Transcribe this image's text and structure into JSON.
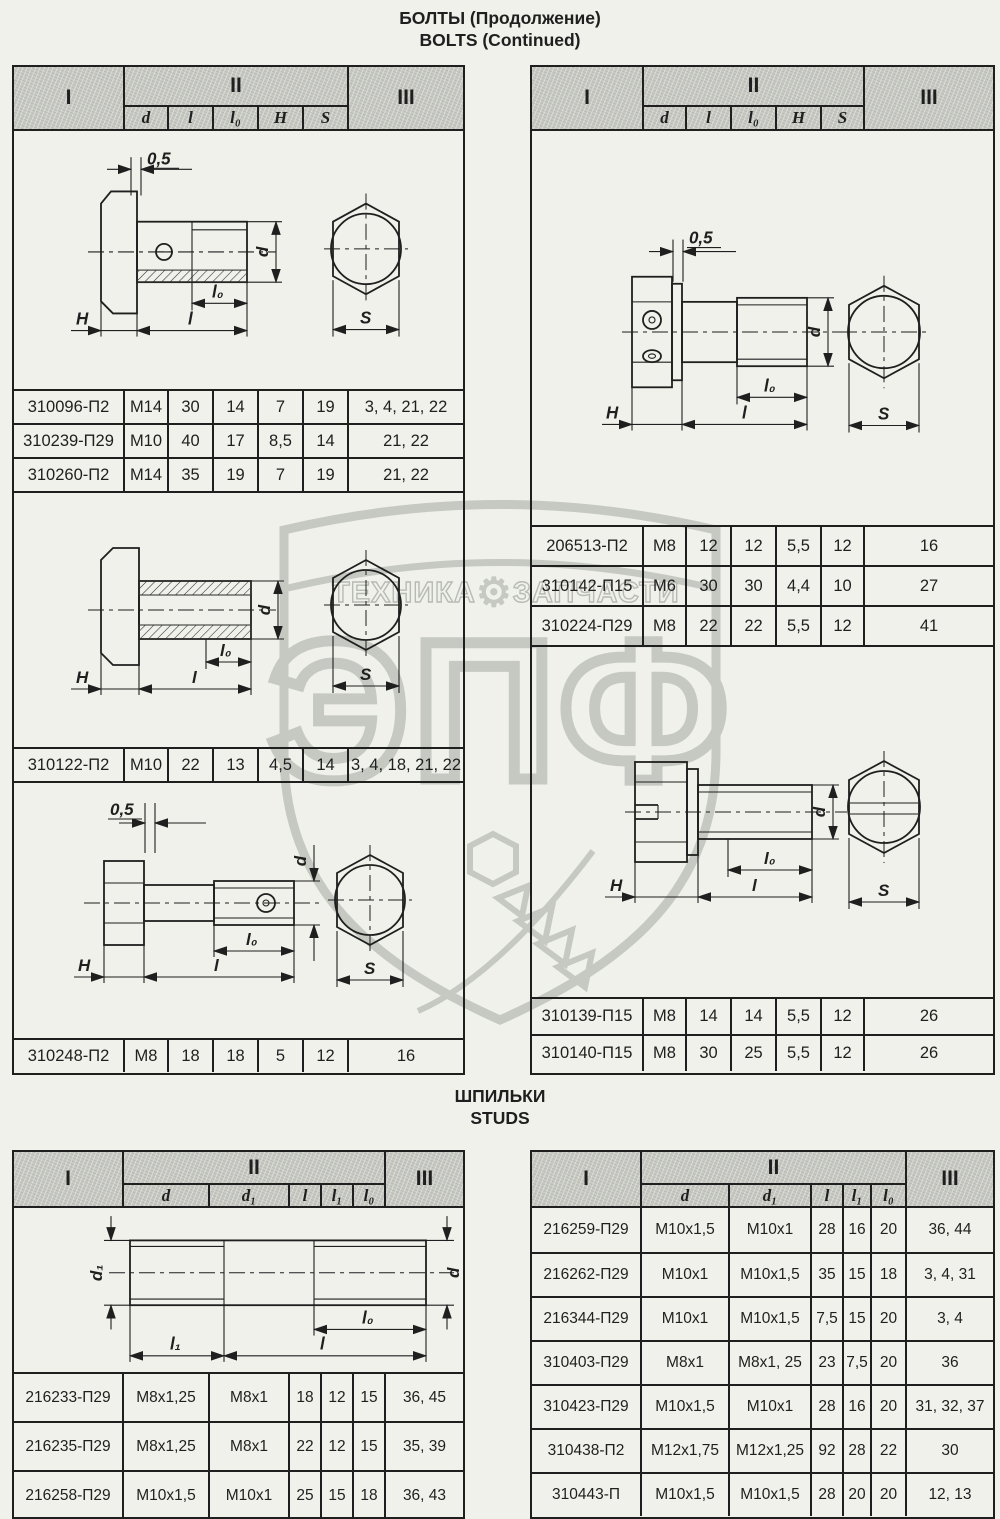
{
  "page": {
    "title_line1": "БОЛТЫ (Продолжение)",
    "title_line2": "BOLTS (Continued)",
    "section2_line1": "ШПИЛЬКИ",
    "section2_line2": "STUDS"
  },
  "labels": {
    "I": "I",
    "II": "II",
    "III": "III",
    "d": "d",
    "l": "l",
    "l0": "l₀",
    "H": "H",
    "S": "S",
    "d1": "d₁",
    "l1": "l₁",
    "offset": "0,5"
  },
  "watermark": {
    "brand": "ЭПФ",
    "left_word": "ТЕХНИКА",
    "right_word": "ЗАПЧАСТИ",
    "gear_icon": "⚙"
  },
  "bolts_left": {
    "rows_a": [
      [
        "310096-П2",
        "M14",
        "30",
        "14",
        "7",
        "19",
        "3, 4, 21, 22"
      ],
      [
        "310239-П29",
        "M10",
        "40",
        "17",
        "8,5",
        "14",
        "21, 22"
      ],
      [
        "310260-П2",
        "M14",
        "35",
        "19",
        "7",
        "19",
        "21, 22"
      ]
    ],
    "rows_b": [
      [
        "310122-П2",
        "M10",
        "22",
        "13",
        "4,5",
        "14",
        "3, 4, 18, 21, 22"
      ]
    ],
    "rows_c": [
      [
        "310248-П2",
        "M8",
        "18",
        "18",
        "5",
        "12",
        "16"
      ]
    ]
  },
  "bolts_right": {
    "rows_a": [
      [
        "206513-П2",
        "M8",
        "12",
        "12",
        "5,5",
        "12",
        "16"
      ],
      [
        "310142-П15",
        "M6",
        "30",
        "30",
        "4,4",
        "10",
        "27"
      ],
      [
        "310224-П29",
        "M8",
        "22",
        "22",
        "5,5",
        "12",
        "41"
      ]
    ],
    "rows_b": [
      [
        "310139-П15",
        "M8",
        "14",
        "14",
        "5,5",
        "12",
        "26"
      ],
      [
        "310140-П15",
        "M8",
        "30",
        "25",
        "5,5",
        "12",
        "26"
      ]
    ]
  },
  "studs_left": {
    "rows": [
      [
        "216233-П29",
        "M8x1,25",
        "M8x1",
        "18",
        "12",
        "15",
        "36, 45"
      ],
      [
        "216235-П29",
        "M8x1,25",
        "M8x1",
        "22",
        "12",
        "15",
        "35, 39"
      ],
      [
        "216258-П29",
        "M10x1,5",
        "M10x1",
        "25",
        "15",
        "18",
        "36, 43"
      ]
    ]
  },
  "studs_right": {
    "rows": [
      [
        "216259-П29",
        "M10x1,5",
        "M10x1",
        "28",
        "16",
        "20",
        "36, 44"
      ],
      [
        "216262-П29",
        "M10x1",
        "M10x1,5",
        "35",
        "15",
        "18",
        "3, 4, 31"
      ],
      [
        "216344-П29",
        "M10x1",
        "M10x1,5",
        "7,5",
        "15",
        "20",
        "3, 4"
      ],
      [
        "310403-П29",
        "M8x1",
        "M8x1, 25",
        "23",
        "7,5",
        "20",
        "36"
      ],
      [
        "310423-П29",
        "M10x1,5",
        "M10x1",
        "28",
        "16",
        "20",
        "31, 32, 37"
      ],
      [
        "310438-П2",
        "M12x1,75",
        "M12x1,25",
        "92",
        "28",
        "22",
        "30"
      ],
      [
        "310443-П",
        "M10x1,5",
        "M10x1,5",
        "28",
        "20",
        "20",
        "12, 13"
      ]
    ]
  }
}
